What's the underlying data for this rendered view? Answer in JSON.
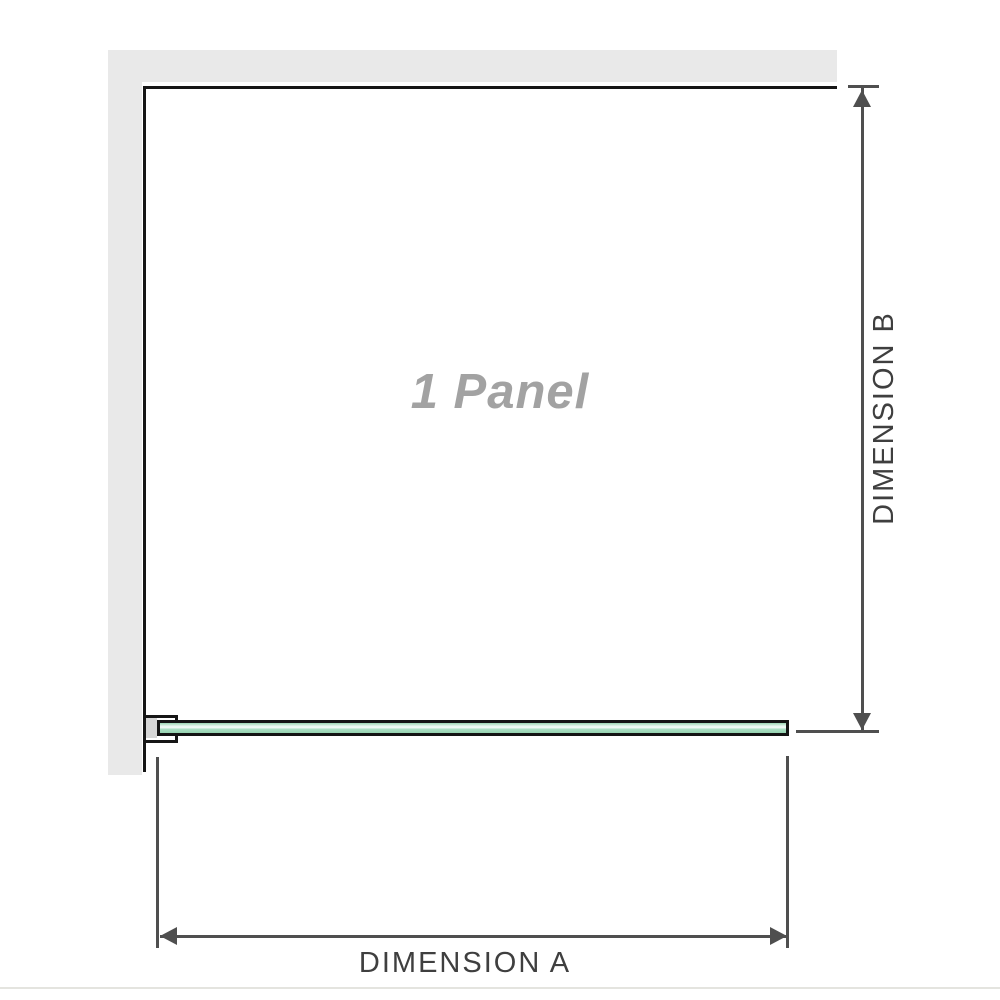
{
  "diagram": {
    "panel_label": "1 Panel",
    "dimension_a_label": "DIMENSION A",
    "dimension_b_label": "DIMENSION B"
  },
  "icons": {
    "dim_b_arrow_up": "triangle-up",
    "dim_b_arrow_down": "triangle-down",
    "dim_a_arrow_left": "triangle-left",
    "dim_a_arrow_right": "triangle-right"
  },
  "theme": {
    "background": "#ffffff",
    "wall_color": "#e9e9e9",
    "outline_color": "#161616",
    "glass_border": "#141414",
    "bracket_inner": "#d6d6d6",
    "dimension_color": "#4f4f4f",
    "label_color": "#3f3f3f",
    "panel_label_color": "#a2a2a2",
    "baseline_color": "#e4e4df",
    "glass_top": "#9ad5b3",
    "glass_light": "#e9f7f0",
    "glass_mid": "#abdfc4",
    "glass_bottom": "#95d2b0"
  }
}
